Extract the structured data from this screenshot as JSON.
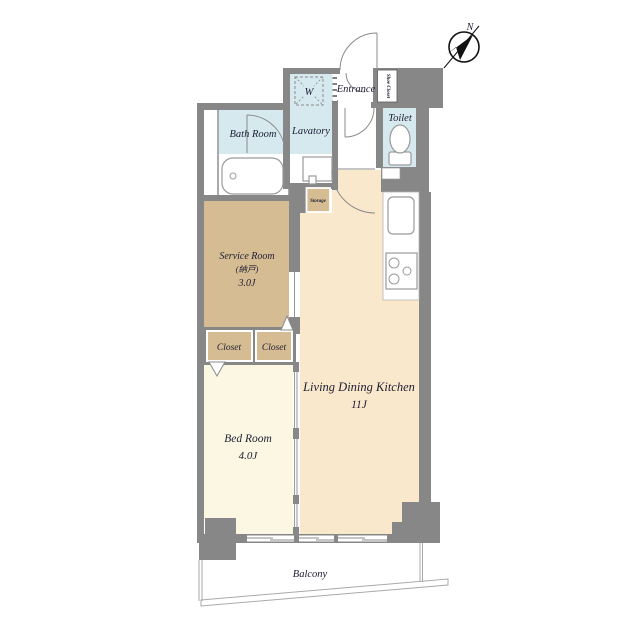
{
  "title": "apartment-floor-plan",
  "colors": {
    "wall": "#878787",
    "wet_room": "#d5e9ef",
    "tatami_tan": "#d5bc92",
    "ldk": "#f9e8cc",
    "bedroom": "#fbf7e2",
    "text": "#1d1d33",
    "compass": "#111111"
  },
  "compass": {
    "label": "N"
  },
  "rooms": {
    "bath": {
      "label": "Bath Room"
    },
    "lavatory": {
      "label": "Lavatory"
    },
    "washer": {
      "label": "W"
    },
    "entrance": {
      "label": "Entrance"
    },
    "shoe_closet": {
      "label": "Shoe Closet"
    },
    "toilet": {
      "label": "Toilet"
    },
    "storage": {
      "label": "Storage"
    },
    "service": {
      "name": "Service Room",
      "kanji": "(納戸)",
      "size": "3.0J"
    },
    "closet_left": {
      "label": "Closet"
    },
    "closet_right": {
      "label": "Closet"
    },
    "ldk": {
      "name": "Living Dining Kitchen",
      "size": "11J"
    },
    "bedroom": {
      "name": "Bed Room",
      "size": "4.0J"
    },
    "balcony": {
      "label": "Balcony"
    }
  }
}
